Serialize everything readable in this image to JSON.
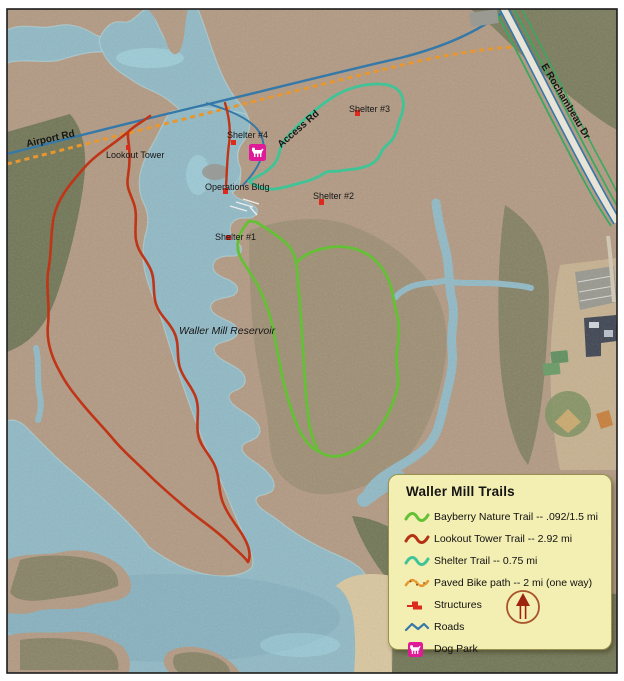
{
  "map": {
    "labels": {
      "airport_rd": "Airport Rd",
      "lookout_tower": "Lookout Tower",
      "shelter_4": "Shelter #4",
      "access_rd": "Access Rd",
      "shelter_3": "Shelter #3",
      "operations_bldg": "Operations Bldg",
      "shelter_2": "Shelter #2",
      "shelter_1": "Shelter #1",
      "reservoir": "Waller Mill Reservoir",
      "rochambeau": "E Rochambeau Dr"
    },
    "colors": {
      "water": "#90b9c5",
      "water_deep": "#7fa9b8",
      "water_bright": "#a8dde8",
      "land": "#b29a83",
      "forest": "#5d6b49",
      "beach": "#d8c69e",
      "trail_bayberry": "#64c135",
      "trail_lookout": "#c03517",
      "trail_shelter": "#3fc497",
      "bike_path": "#e8962e",
      "road": "#3579a9",
      "road_green": "#3aa85e",
      "structure": "#dd2a1d",
      "dog_park": "#e01b98"
    }
  },
  "legend": {
    "title": "Waller Mill Trails",
    "items": [
      {
        "label": "Bayberry Nature Trail -- .092/1.5 mi",
        "color": "#64c135"
      },
      {
        "label": "Lookout Tower Trail -- 2.92 mi",
        "color": "#b33214"
      },
      {
        "label": "Shelter Trail -- 0.75 mi",
        "color": "#3fc497"
      },
      {
        "label": "Paved Bike path -- 2 mi (one way)",
        "color": "#e8962e"
      },
      {
        "label": "Structures",
        "color": "#dd2a1d"
      },
      {
        "label": "Roads",
        "color": "#3579a9"
      },
      {
        "label": "Dog Park",
        "color": "#e01b98"
      }
    ]
  }
}
